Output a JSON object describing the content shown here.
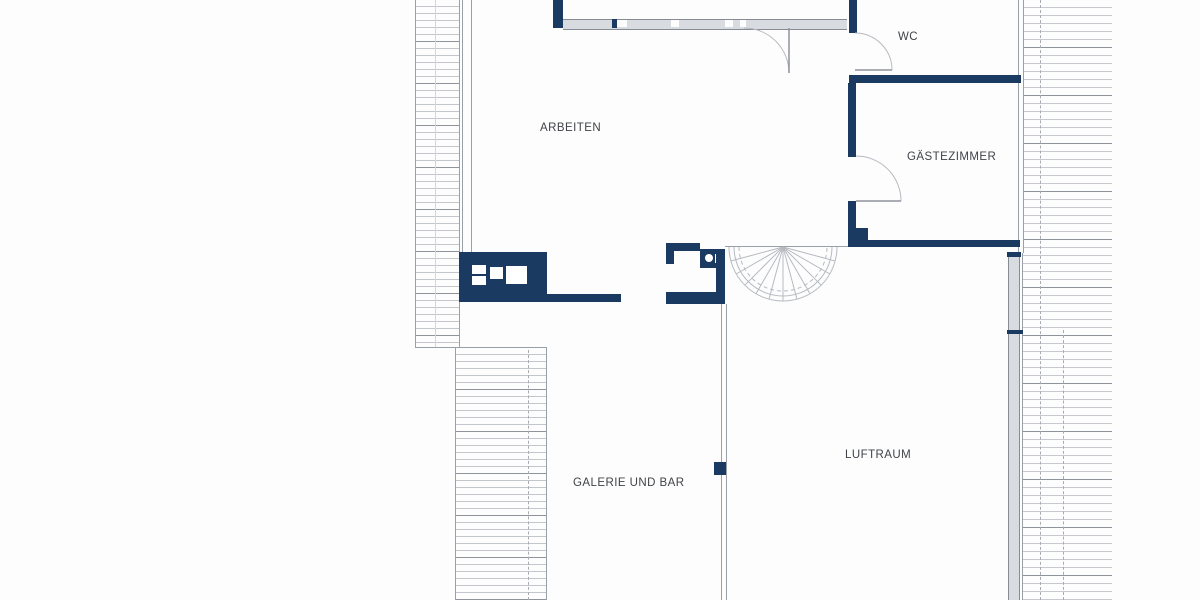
{
  "page": {
    "background": "#fdfdfe"
  },
  "plan": {
    "type": "floor-plan",
    "labels": {
      "arbeiten": "ARBEITEN",
      "wc": "WC",
      "gaestezimmer": "GÄSTEZIMMER",
      "galerie_und_bar": "GALERIE UND BAR",
      "luftraum": "LUFTRAUM"
    },
    "colors": {
      "wall": "#1a3a61",
      "line": "#9aa0a8",
      "hatch_light": "#c3c7cc",
      "hatch_dark": "#8f949c",
      "glass": "#d8dbdf",
      "text": "#3f4347",
      "background": "#fdfdfe"
    }
  }
}
